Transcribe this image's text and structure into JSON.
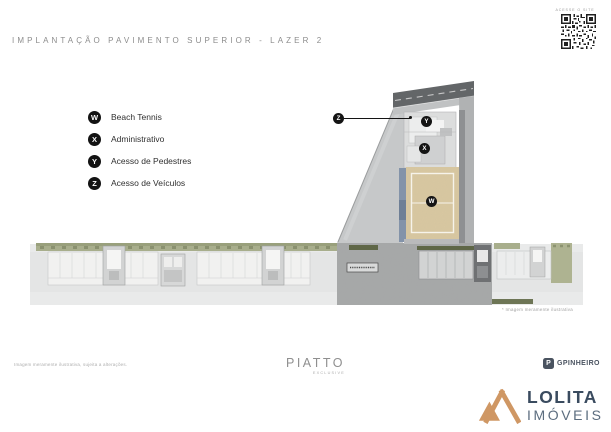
{
  "header": {
    "title": "IMPLANTAÇÃO PAVIMENTO SUPERIOR - LAZER 2",
    "qr_caption": "ACESSE O SITE"
  },
  "legend": {
    "items": [
      {
        "letter": "W",
        "label": "Beach Tennis"
      },
      {
        "letter": "X",
        "label": "Administrativo"
      },
      {
        "letter": "Y",
        "label": "Acesso de Pedestres"
      },
      {
        "letter": "Z",
        "label": "Acesso de Veículos"
      }
    ]
  },
  "plan": {
    "markers": [
      {
        "letter": "W"
      },
      {
        "letter": "X"
      },
      {
        "letter": "Y"
      },
      {
        "letter": "Z"
      }
    ],
    "note": "* Imagem meramente ilustrativa"
  },
  "footer": {
    "disclaimer": "Imagem meramente ilustrativa, sujeita a alterações.",
    "developer_brand": "PIATTO",
    "developer_tagline": "EXCLUSIVE",
    "construction_brand": "GPINHEIRO",
    "construction_icon_letter": "P",
    "realtor_brand": "LOLITA",
    "realtor_suffix": "IMÓVEIS"
  },
  "colors": {
    "sand_court": "#d9c8a1",
    "brand_tan": "#cf9764",
    "brand_navy": "#3a4b5f",
    "road_dark": "#636668",
    "green_olive": "#a8ae8c"
  }
}
